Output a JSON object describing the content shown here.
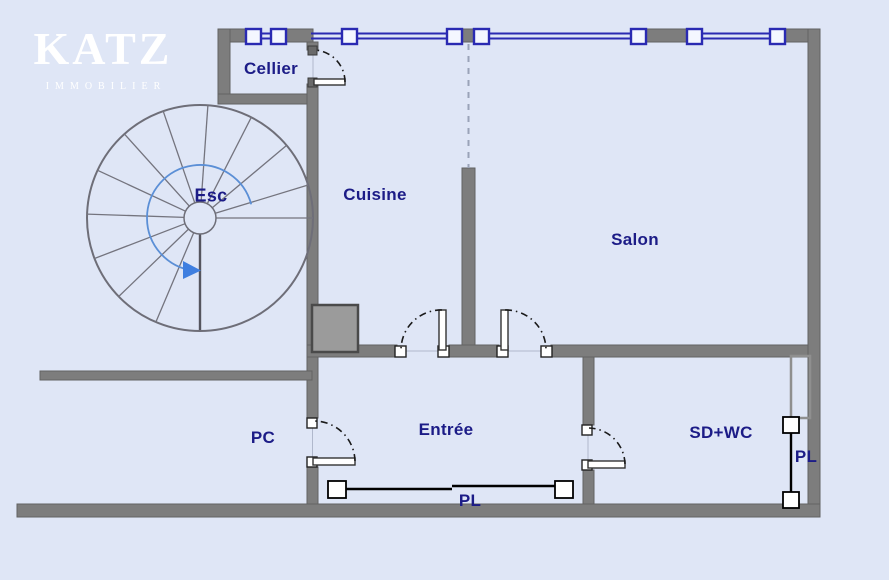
{
  "logo": {
    "brand": "KATZ",
    "tagline": "IMMOBILIER"
  },
  "rooms": {
    "cellier": "Cellier",
    "cuisine": "Cuisine",
    "salon": "Salon",
    "staircase": "Esc",
    "pc": "PC",
    "entree": "Entrée",
    "sdwc": "SD+WC",
    "closet_entree": "PL",
    "closet_sdwc": "PL"
  },
  "colors": {
    "background": "#dfe6f6",
    "wall_gray": "#7d7d7d",
    "window_blue": "#2a2ab2",
    "label_navy": "#1c1c87",
    "stair_line_gray": "#74747e",
    "stair_direction_blue": "#3f7fe0",
    "door_arc_black": "#1a1a1a",
    "logo_white": "#ffffff"
  }
}
